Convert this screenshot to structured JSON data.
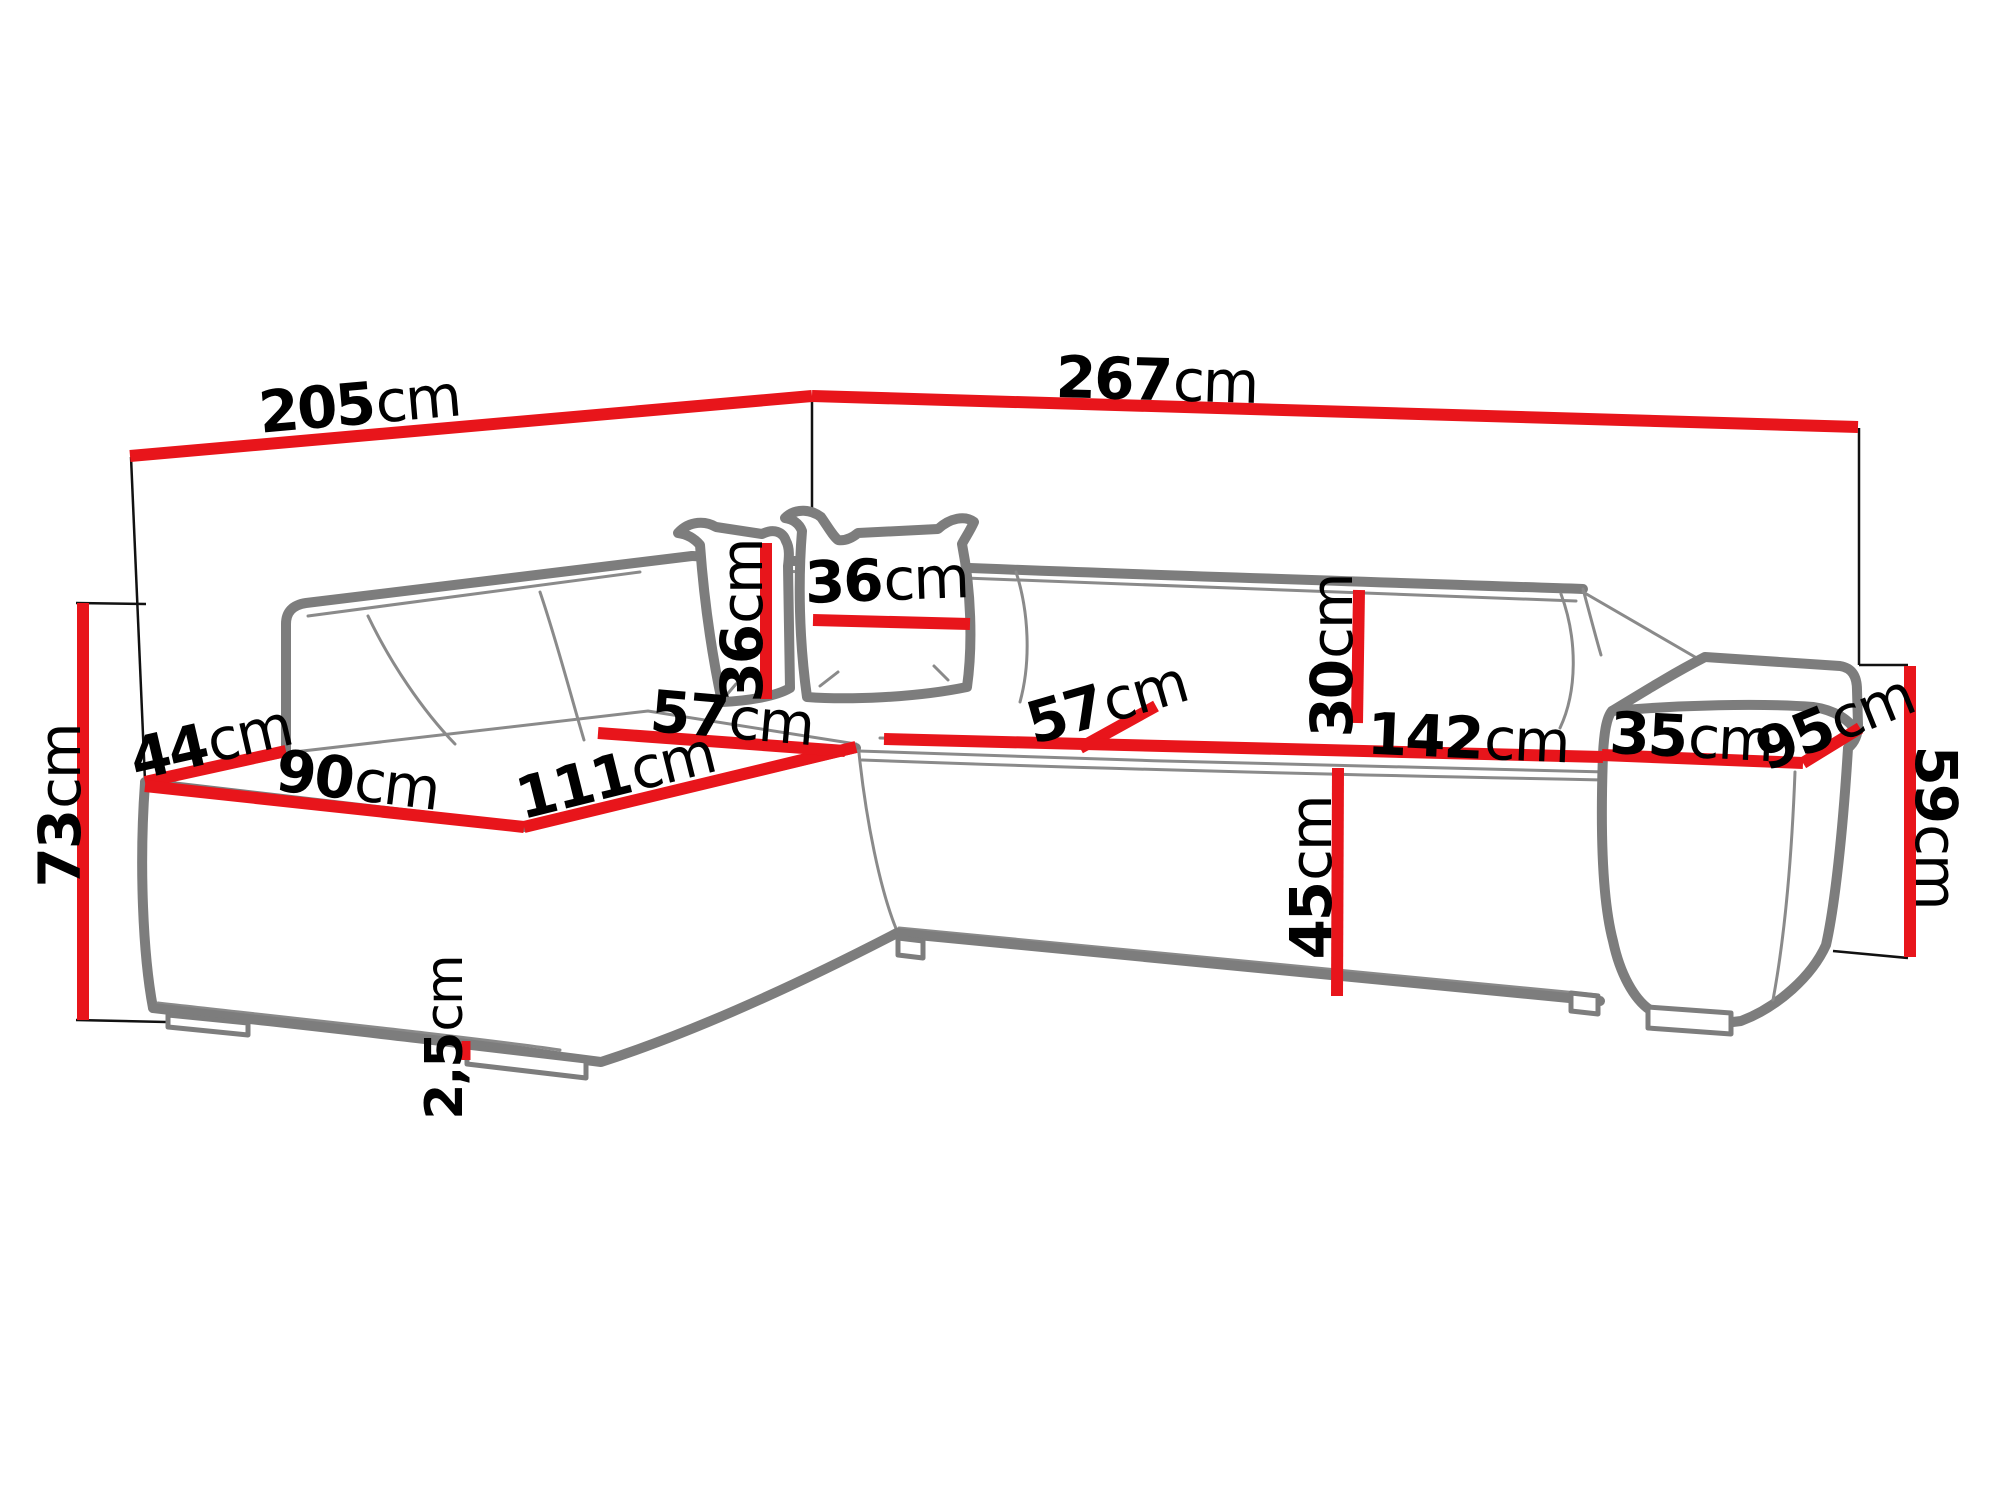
{
  "diagram": {
    "type": "furniture-dimension-diagram",
    "subject": "corner sofa with chaise longue, cushions and armrest",
    "unit": "cm",
    "colors": {
      "dimension_red": "#e8151b",
      "outline_gray": "#7d7d7d",
      "seam_gray": "#8a8a8a",
      "extension_black": "#111111",
      "label_text": "#000000",
      "background": "#ffffff"
    }
  },
  "measurements": {
    "back_edge_left": {
      "value": "205",
      "unit": "cm"
    },
    "back_edge_right": {
      "value": "267",
      "unit": "cm"
    },
    "overall_height": {
      "value": "73",
      "unit": "cm"
    },
    "left_side_depth": {
      "value": "44",
      "unit": "cm"
    },
    "chaise_front_edge": {
      "value": "90",
      "unit": "cm"
    },
    "chaise_length": {
      "value": "111",
      "unit": "cm"
    },
    "chaise_seat_width": {
      "value": "57",
      "unit": "cm"
    },
    "pillow_height": {
      "value": "36",
      "unit": "cm"
    },
    "pillow_width": {
      "value": "36",
      "unit": "cm"
    },
    "seat_depth": {
      "value": "57",
      "unit": "cm"
    },
    "backrest_cushion_height": {
      "value": "30",
      "unit": "cm"
    },
    "seat_length": {
      "value": "142",
      "unit": "cm"
    },
    "seat_height": {
      "value": "45",
      "unit": "cm"
    },
    "armrest_top_width": {
      "value": "35",
      "unit": "cm"
    },
    "overall_depth": {
      "value": "95",
      "unit": "cm"
    },
    "armrest_height": {
      "value": "59",
      "unit": "cm"
    },
    "leg_height": {
      "value": "2,5",
      "unit": "cm"
    }
  }
}
